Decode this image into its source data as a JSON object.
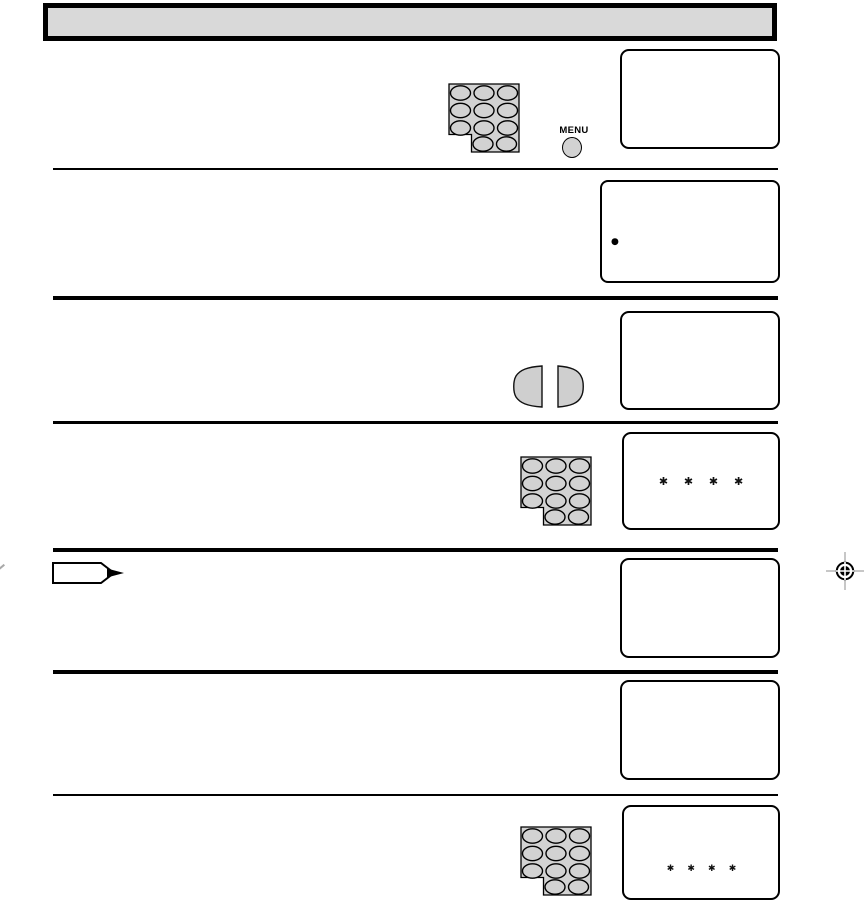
{
  "document": {
    "type": "tv-manual-procedure-page",
    "title_bar_text": ""
  },
  "remote_controls": {
    "menu_label": "MENU"
  },
  "screens": [
    {
      "id": "screen-1",
      "text": ""
    },
    {
      "id": "screen-2",
      "text": "●"
    },
    {
      "id": "screen-3",
      "text": ""
    },
    {
      "id": "screen-4",
      "text": "✱ ✱ ✱ ✱"
    },
    {
      "id": "screen-5",
      "text": ""
    },
    {
      "id": "screen-6",
      "text": ""
    },
    {
      "id": "screen-7",
      "text": "✱ ✱ ✱ ✱"
    }
  ],
  "icons": [
    "keypad-icon",
    "menu-button-icon",
    "left-arrow-button-icon",
    "right-arrow-button-icon",
    "procedure-arrow-icon",
    "registration-mark-icon",
    "bullet-dot-icon"
  ],
  "colors": {
    "titlebar_fill": "#d9d9d9",
    "keypad_fill": "#d2d2d2",
    "button_fill": "#cfcfcf",
    "screen_border": "#000000",
    "line": "#000000",
    "regmark_gray": "#8f8f8f"
  }
}
